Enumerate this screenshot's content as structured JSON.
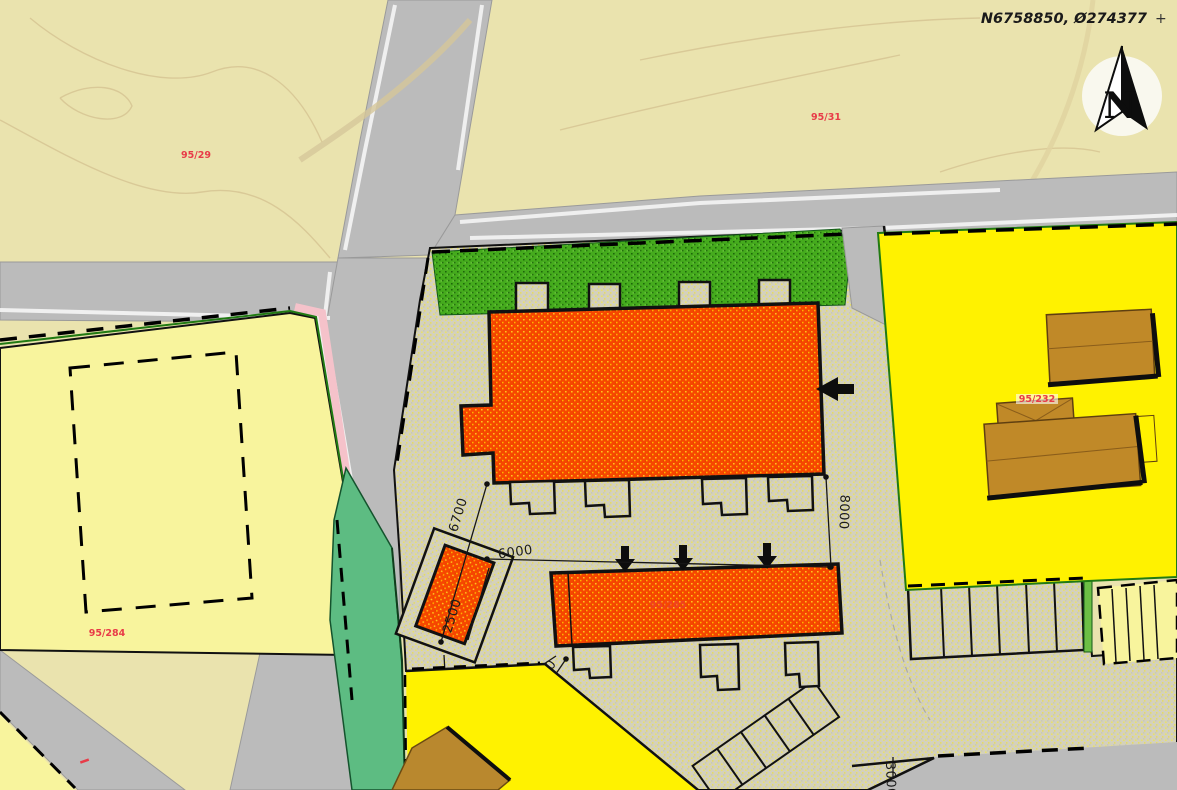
{
  "header": {
    "coordinate_label": "N6758850, Ø274377",
    "crosshair_marker": "+",
    "north_label": "N"
  },
  "parcels": {
    "p95_29": "95/29",
    "p95_31": "95/31",
    "p95_284": "95/284",
    "p95_232": "95/232",
    "p95_285": "95/285"
  },
  "dimensions": {
    "d6700": "6700",
    "d6000": "6000",
    "d8000": "8000",
    "d2500": "2500",
    "d7500": "7500",
    "d11400": "11400",
    "d2900": "2900",
    "d3000": "3000"
  },
  "colors": {
    "road_gray": "#bbbbbb",
    "farmland_beige": "#eae3ae",
    "parcel_yellow_pale": "#f8f49d",
    "parcel_yellow_bright": "#fff200",
    "site_ground_speckle": "#d6d3bd",
    "building_orange": "#f64700",
    "vegetation_green": "#45ab1d",
    "lawn_teal": "#5dbc82",
    "building_brown": "#c08928",
    "boundary_pink": "#f5c2ca",
    "label_red": "#e83b48"
  }
}
